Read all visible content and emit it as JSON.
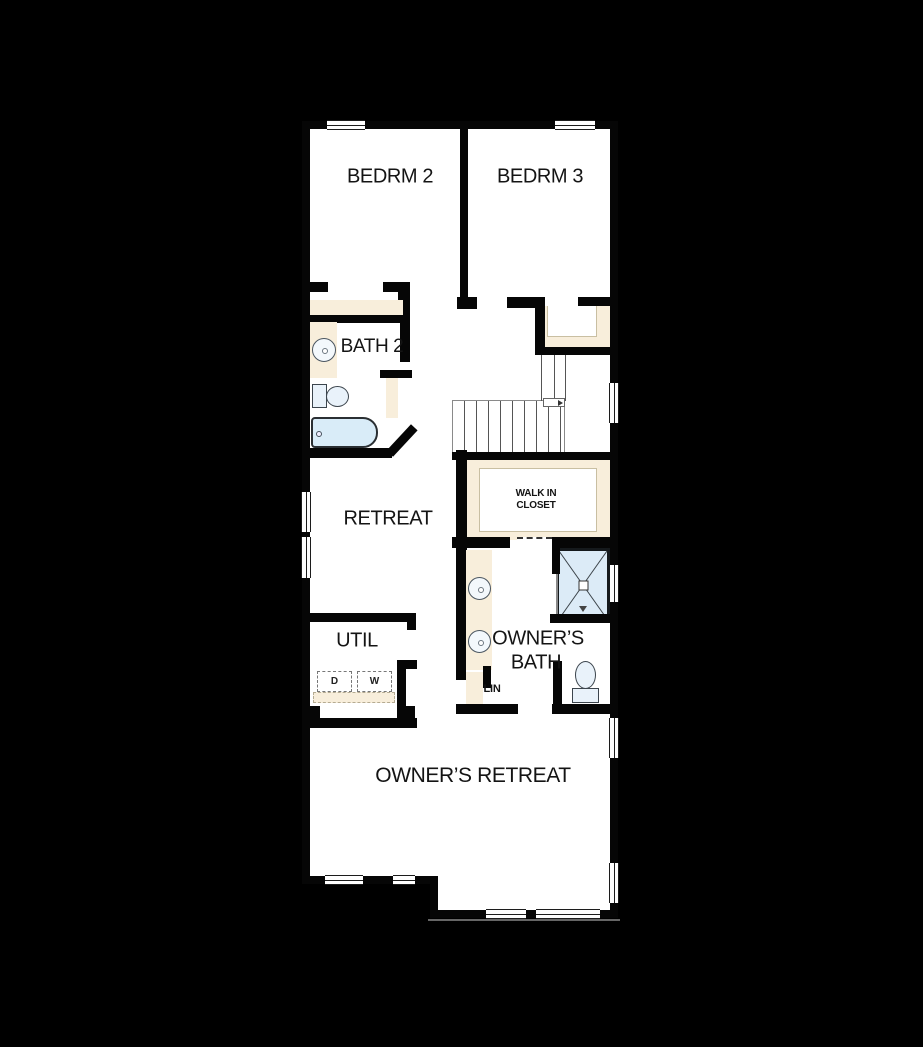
{
  "plan_type": "floor-plan",
  "rooms": {
    "bedrm2": "BEDRM 2",
    "bedrm3": "BEDRM 3",
    "bath2": "BATH 2",
    "retreat": "RETREAT",
    "walk_in_line1": "WALK IN",
    "walk_in_line2": "CLOSET",
    "util": "UTIL",
    "owners_bath_line1": "OWNER’S",
    "owners_bath_line2": "BATH",
    "linen": "LIN",
    "owners_retreat": "OWNER’S RETREAT"
  },
  "appliances": {
    "dryer": "D",
    "washer": "W"
  },
  "colors": {
    "background": "#000000",
    "floor": "#ffffff",
    "wall": "#060606",
    "casework": "#f8eedb",
    "water_fixture": "#d9ecf8"
  }
}
